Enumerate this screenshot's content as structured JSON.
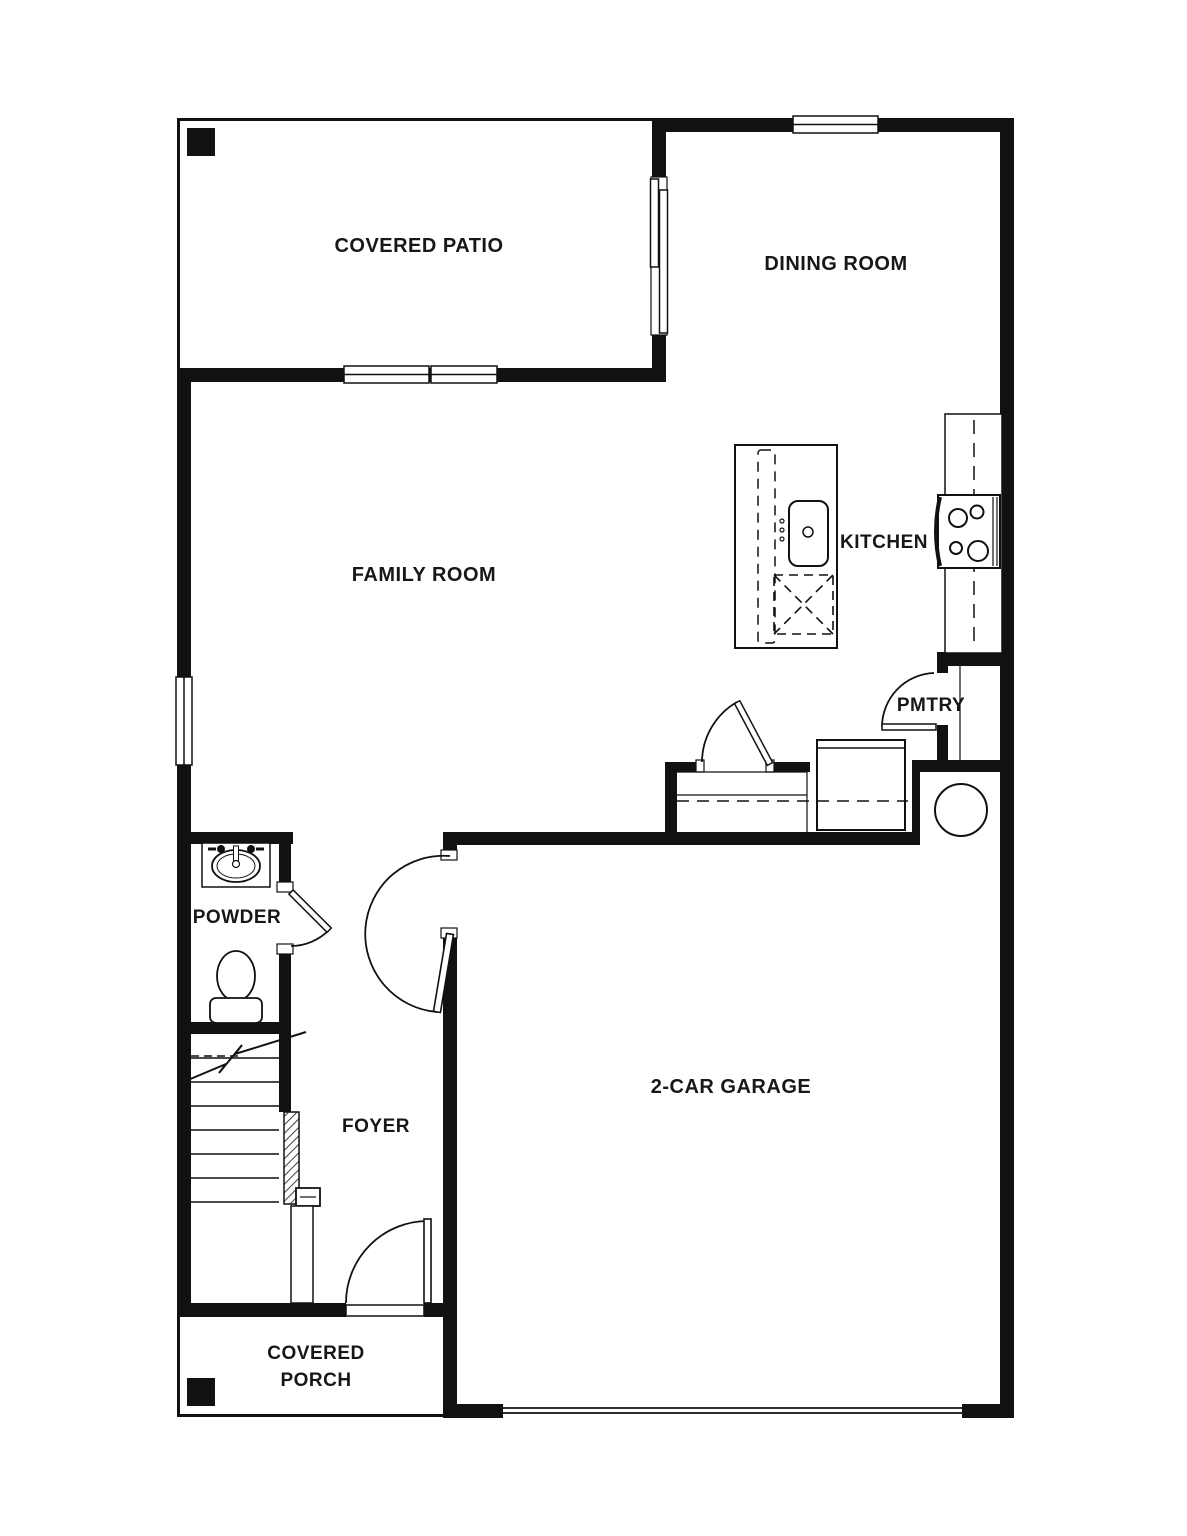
{
  "plan": {
    "type": "first-floor residential floor plan",
    "colors": {
      "wall": "#111111",
      "background": "#ffffff",
      "text": "#171717"
    },
    "rooms": {
      "covered_patio": {
        "label": "COVERED PATIO"
      },
      "dining_room": {
        "label": "DINING ROOM"
      },
      "family_room": {
        "label": "FAMILY ROOM"
      },
      "kitchen": {
        "label": "KITCHEN"
      },
      "pantry": {
        "label": "PMTRY"
      },
      "powder": {
        "label": "POWDER"
      },
      "foyer": {
        "label": "FOYER"
      },
      "garage": {
        "label": "2-CAR GARAGE"
      },
      "covered_porch": {
        "label_line1": "COVERED",
        "label_line2": "PORCH"
      }
    },
    "fixtures": [
      "kitchen-island",
      "island-sink",
      "dishwasher",
      "range-cooktop",
      "counter-refrigerator",
      "pantry-shelf",
      "water-heater",
      "utility-box",
      "drop-zone-closet",
      "powder-vanity-sink",
      "toilet",
      "staircase",
      "stair-handrail",
      "patio-post",
      "porch-post",
      "sliding-glass-door",
      "front-door",
      "garage-entry-door",
      "powder-door",
      "pantry-door",
      "closet-door"
    ]
  }
}
